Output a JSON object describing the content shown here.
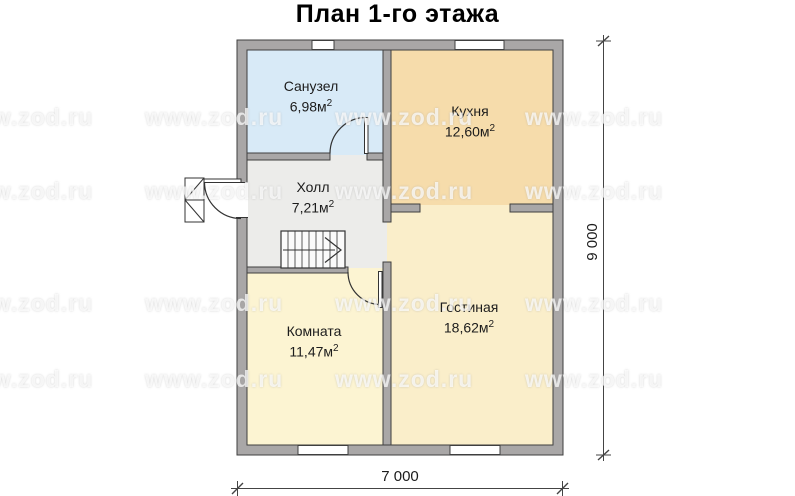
{
  "title": "План 1-го этажа",
  "watermark": {
    "text": "www.zod.ru"
  },
  "labels": {
    "sup": "2"
  },
  "rooms": [
    {
      "name": "Санузел",
      "area": "6,98м"
    },
    {
      "name": "Кухня",
      "area": "12,60м"
    },
    {
      "name": "Холл",
      "area": "7,21м"
    },
    {
      "name": "Комната",
      "area": "11,47м"
    },
    {
      "name": "Гостиная",
      "area": "18,62м"
    }
  ],
  "dimensions": {
    "vertical": "9 000",
    "horizontal": "7 000"
  },
  "colors": {
    "bathroom": "#d8eaf7",
    "kitchen": "#f6dcab",
    "hall": "#ececea",
    "room": "#fcf4d2",
    "living": "#faeeca",
    "wall": "#a9a7a7",
    "wall_outline": "#3f3f3f",
    "dim_line": "#444444",
    "label_text": "#1c1c1c"
  }
}
